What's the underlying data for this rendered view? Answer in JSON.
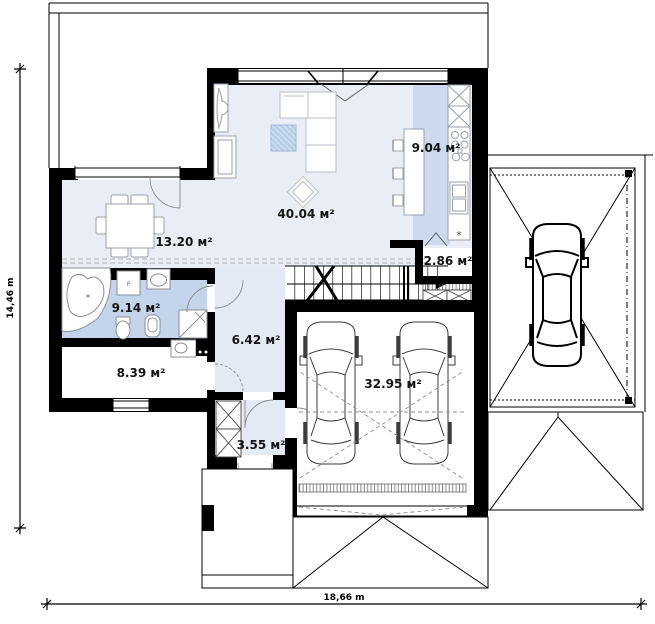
{
  "floor_plan": {
    "rooms": {
      "living": "40.04 м²",
      "dining": "13.20 м²",
      "kitchen": "9.04 м²",
      "pantry": "2.86 м²",
      "bathroom": "9.14 м²",
      "hall": "6.42 м²",
      "utility": "8.39 м²",
      "vestibule": "3.55 м²",
      "garage": "32.95 м²"
    },
    "dimensions": {
      "overall_height": "14,46 m",
      "overall_width": "18,66 m"
    },
    "symbols": {
      "washer": "P",
      "kitchen_asterisk": "*"
    },
    "colors": {
      "room_light": "#e9eef6",
      "room_medium": "#c3d4eb",
      "kitchen_strip": "#ccdaee",
      "wall": "#000000"
    }
  }
}
